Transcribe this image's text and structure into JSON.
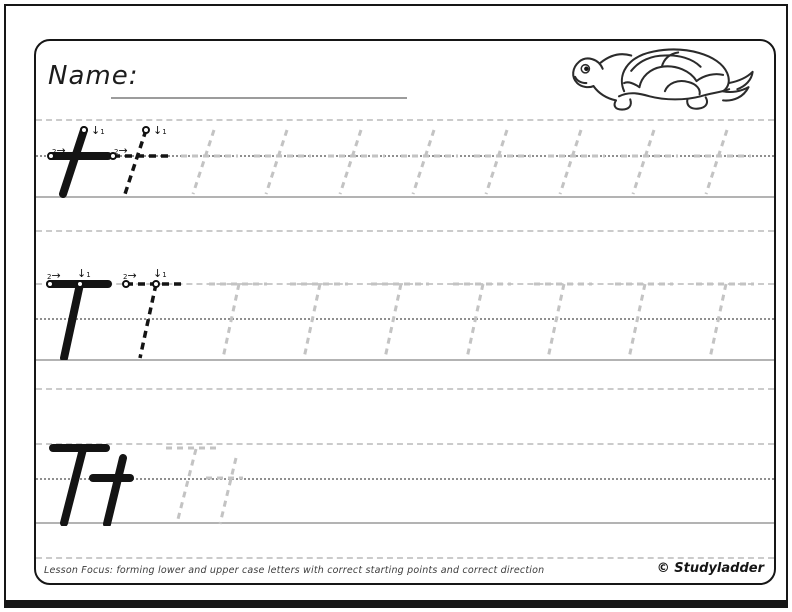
{
  "header": {
    "name_label": "Name:"
  },
  "illustration": {
    "name": "turtle"
  },
  "practice": {
    "rows": [
      {
        "letter": "t",
        "style": "lowercase",
        "examples": [
          "solid",
          "dashed"
        ],
        "trace_count": 8,
        "show_stroke_guides": true
      },
      {
        "letter": "T",
        "style": "uppercase",
        "examples": [
          "solid",
          "dashed"
        ],
        "trace_count": 7,
        "show_stroke_guides": true
      },
      {
        "letter": "Tt",
        "style": "pair",
        "examples": [
          "solid"
        ],
        "trace_count": 1,
        "show_stroke_guides": false
      }
    ],
    "stroke_guides": {
      "stroke1_num": "1",
      "stroke1_arrow": "↓",
      "stroke2_num": "2",
      "stroke2_arrow": "→"
    }
  },
  "footer": {
    "lesson_focus": "Lesson Focus: forming lower and upper case letters with correct starting points and correct direction",
    "copyright": "© Studyladder"
  },
  "colors": {
    "ink": "#141414",
    "trace": "#c3c3c3",
    "guide_dash": "#cbcbcb",
    "guide_dot": "#8f8f8f",
    "baseline": "#b3b3b3"
  }
}
